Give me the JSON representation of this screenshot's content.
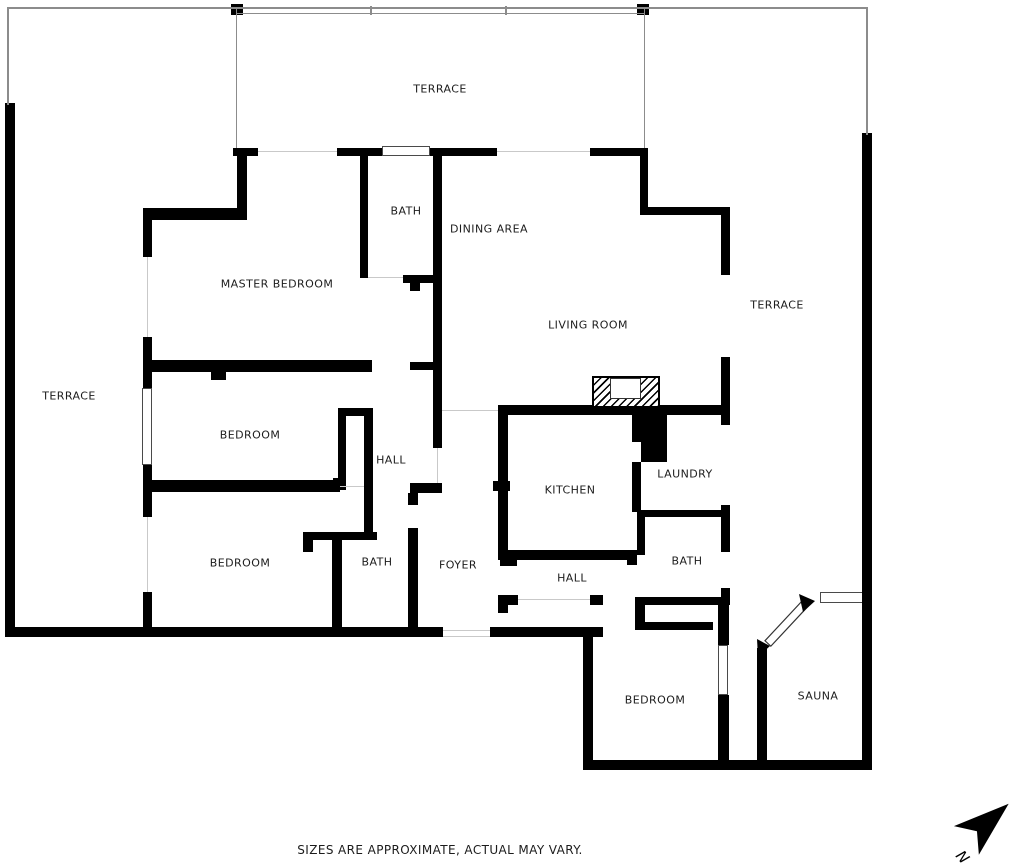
{
  "plan_title": "floor-plan",
  "rooms": [
    {
      "label": "TERRACE",
      "area": "top"
    },
    {
      "label": "BATH",
      "area": "top-center"
    },
    {
      "label": "DINING AREA",
      "area": "center-top"
    },
    {
      "label": "MASTER BEDROOM",
      "area": "left-top"
    },
    {
      "label": "LIVING ROOM",
      "area": "center"
    },
    {
      "label": "TERRACE",
      "area": "right"
    },
    {
      "label": "TERRACE",
      "area": "left"
    },
    {
      "label": "BEDROOM",
      "area": "left-middle"
    },
    {
      "label": "HALL",
      "area": "middle"
    },
    {
      "label": "KITCHEN",
      "area": "center-right"
    },
    {
      "label": "LAUNDRY",
      "area": "right-of-kitchen"
    },
    {
      "label": "BEDROOM",
      "area": "left-bottom"
    },
    {
      "label": "BATH",
      "area": "bottom-left-center"
    },
    {
      "label": "FOYER",
      "area": "bottom-center"
    },
    {
      "label": "HALL",
      "area": "bottom-center-right"
    },
    {
      "label": "BATH",
      "area": "bottom-right-center"
    },
    {
      "label": "BEDROOM",
      "area": "bottom-extension"
    },
    {
      "label": "SAUNA",
      "area": "bottom-right"
    }
  ],
  "disclaimer": "SIZES ARE APPROXIMATE, ACTUAL MAY VARY.",
  "compass": {
    "letter": "N",
    "direction": "north-east"
  },
  "colors": {
    "wall": "#000000",
    "thin_line": "#8c8c8c",
    "background": "#ffffff",
    "text": "#1c1c1c"
  }
}
